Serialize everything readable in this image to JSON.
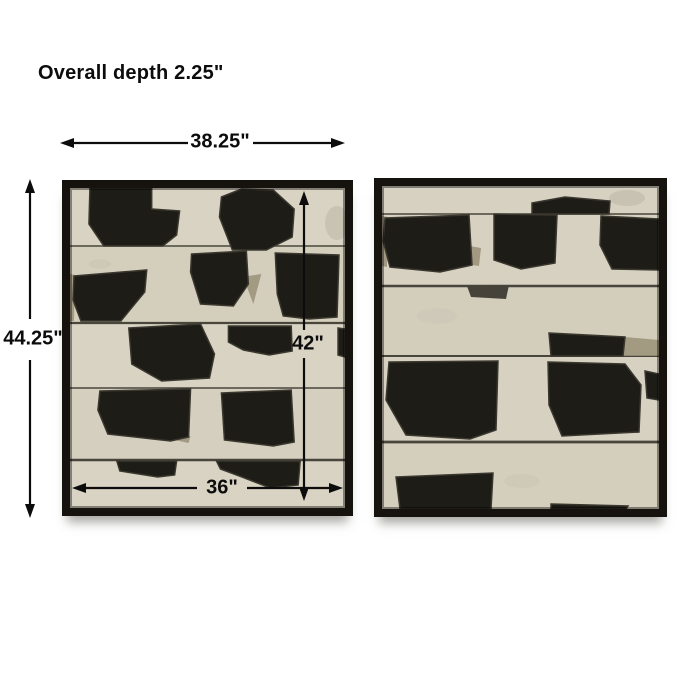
{
  "annotations": {
    "overall_depth": "Overall depth 2.25\"",
    "frame_width": "38.25\"",
    "frame_height": "44.25\"",
    "art_height": "42\"",
    "art_width": "36\""
  },
  "colors": {
    "background": "#ffffff",
    "text": "#0c0c0c",
    "arrow": "#0c0c0c",
    "frame": "#16130e",
    "canvas_left": "#d9d3c3",
    "canvas_right": "#d7d1c1",
    "ink": "#1e1c17",
    "ink_soft": "#46443a",
    "seam": "#2f2d25",
    "tan_accent": "#9a9078",
    "haze": "#bab4a3"
  }
}
